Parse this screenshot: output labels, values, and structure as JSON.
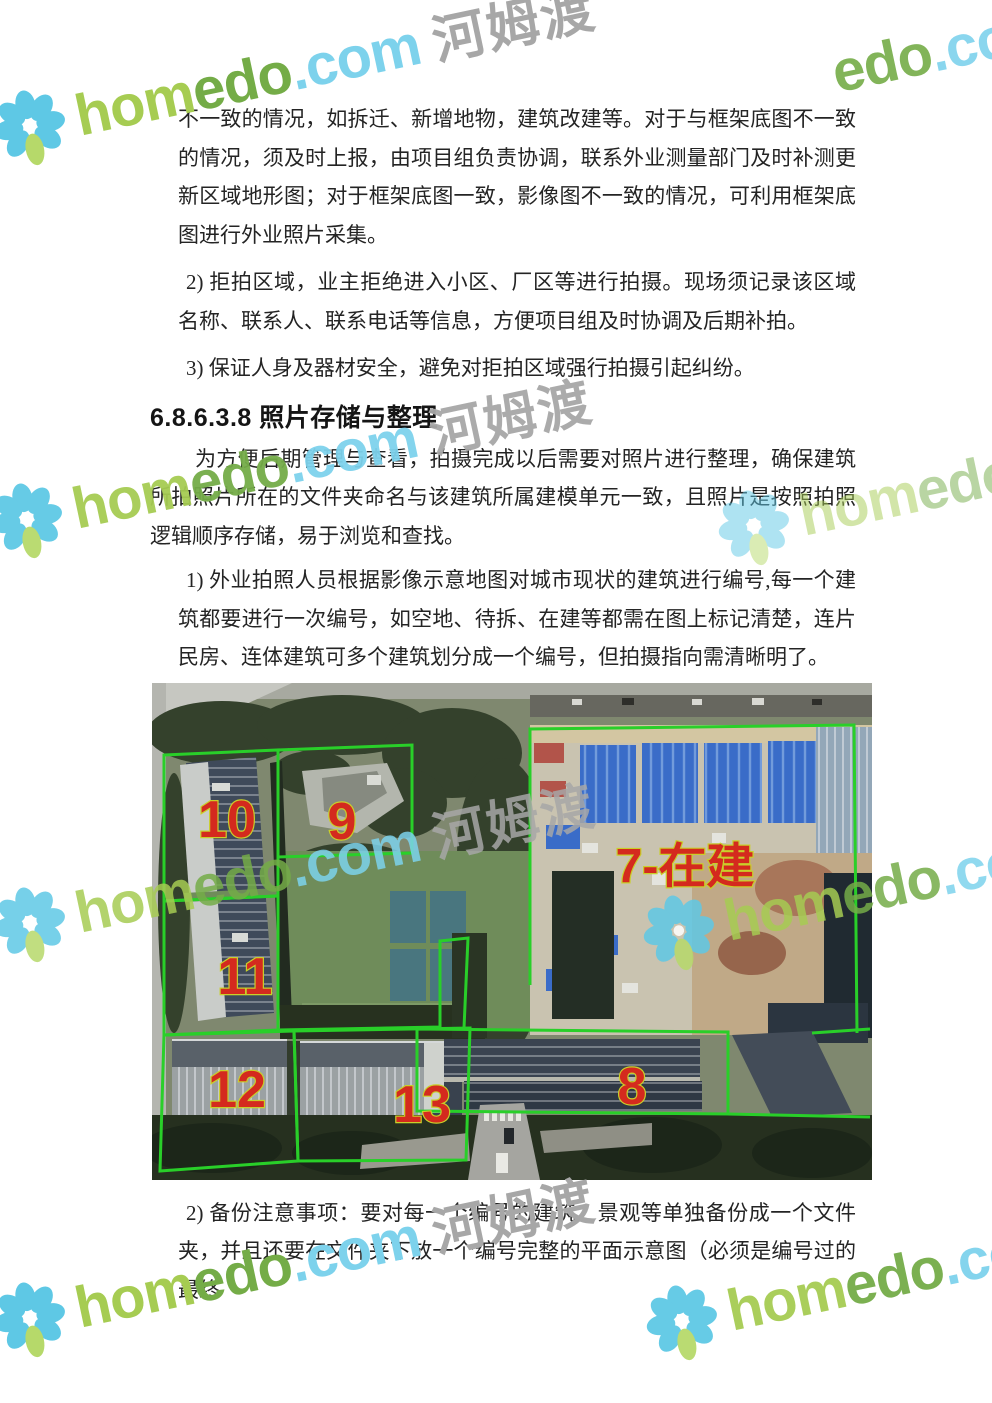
{
  "page": {
    "width": 992,
    "height": 1403,
    "background": "#ffffff"
  },
  "content": {
    "heading": "6.8.6.3.8 照片存储与整理",
    "paragraphs": [
      {
        "text": "不一致的情况，如拆迁、新增地物，建筑改建等。对于与框架底图不一致的情况，须及时上报，由项目组负责协调，联系外业测量部门及时补测更新区域地形图；对于框架底图一致，影像图不一致的情况，可利用框架底图进行外业照片采集。"
      },
      {
        "text": "2) 拒拍区域，业主拒绝进入小区、厂区等进行拍摄。现场须记录该区域名称、联系人、联系电话等信息，方便项目组及时协调及后期补拍。"
      },
      {
        "text": "3) 保证人身及器材安全，避免对拒拍区域强行拍摄引起纠纷。"
      },
      {
        "text": "为方便后期管理与查看，拍摄完成以后需要对照片进行整理，确保建筑所拍照片所在的文件夹命名与该建筑所属建模单元一致，且照片是按照拍照逻辑顺序存储，易于浏览和查找。"
      },
      {
        "text": "1) 外业拍照人员根据影像示意地图对城市现状的建筑进行编号,每一个建筑都要进行一次编号，如空地、待拆、在建等都需在图上标记清楚，连片民房、连体建筑可多个建筑划分成一个编号，但拍摄指向需清晰明了。"
      },
      {
        "text": "2) 备份注意事项：要对每一个编号的建筑、景观等单独备份成一个文件夹，并且还要在文件夹下放一个编号完整的平面示意图（必须是编号过的最终"
      }
    ]
  },
  "watermark": {
    "brand_part1": "hom",
    "brand_part2": "edo",
    "brand_suffix": ".com",
    "brand_cjk": "河姆渡",
    "colors": {
      "part1": "#a6cc52",
      "part2": "#74ac47",
      "suffix": "#7dd2ec",
      "cjk": "#a7a7a7",
      "petal": "#5ec8e5",
      "leaf": "#b6d96a"
    },
    "instances": [
      {
        "x": -7,
        "y": 93,
        "flower": true,
        "part1": true,
        "part2": true,
        "suffix": true,
        "cjk": true,
        "opacity": 1
      },
      {
        "x": 833,
        "y": 45,
        "flower": false,
        "part1": false,
        "part2": true,
        "suffix": true,
        "cjk": false,
        "opacity": 0.9
      },
      {
        "x": -10,
        "y": 486,
        "flower": true,
        "part1": true,
        "part2": true,
        "suffix": true,
        "cjk": true,
        "opacity": 0.95
      },
      {
        "x": 717,
        "y": 493,
        "flower": true,
        "part1": true,
        "part2": true,
        "suffix": true,
        "cjk": true,
        "opacity": 0.5
      },
      {
        "x": -7,
        "y": 890,
        "flower": true,
        "part1": true,
        "part2": true,
        "suffix": true,
        "cjk": true,
        "opacity": 0.85
      },
      {
        "x": 642,
        "y": 898,
        "flower": true,
        "part1": true,
        "part2": true,
        "suffix": true,
        "cjk": true,
        "opacity": 0.85
      },
      {
        "x": -7,
        "y": 1285,
        "flower": true,
        "part1": true,
        "part2": true,
        "suffix": true,
        "cjk": true,
        "opacity": 1
      },
      {
        "x": 645,
        "y": 1288,
        "flower": true,
        "part1": true,
        "part2": true,
        "suffix": true,
        "cjk": true,
        "opacity": 0.95
      }
    ]
  },
  "figure": {
    "outline_color": "#29cf29",
    "label_fill": "#d42a1e",
    "label_stroke": "#c9cf2a",
    "polygons": [
      {
        "points": "12,72 126,67 126,213 12,218",
        "closed": true
      },
      {
        "points": "12,218 126,213 126,347 12,352",
        "closed": true
      },
      {
        "points": "126,67 260,62 260,170 126,174",
        "closed": true
      },
      {
        "points": "126,347 288,344 288,258 316,255 312,345",
        "closed": false
      },
      {
        "points": "12,352 142,348 146,478 8,488",
        "closed": true
      },
      {
        "points": "142,348 318,345 314,477 146,478",
        "closed": true
      },
      {
        "points": "378,302 378,46 702,42 705,350",
        "closed": false
      },
      {
        "points": "265,346 576,349 576,431 265,428",
        "closed": true
      },
      {
        "points": "576,431 718,434",
        "closed": false
      },
      {
        "points": "660,350 718,346",
        "closed": false
      }
    ],
    "labels": [
      {
        "text": "10",
        "x": 75,
        "y": 137,
        "size": 52
      },
      {
        "text": "9",
        "x": 190,
        "y": 139,
        "size": 52
      },
      {
        "text": "7-在建",
        "x": 533,
        "y": 184,
        "size": 48
      },
      {
        "text": "11",
        "x": 93,
        "y": 294,
        "size": 52
      },
      {
        "text": "12",
        "x": 85,
        "y": 407,
        "size": 52
      },
      {
        "text": "13",
        "x": 270,
        "y": 422,
        "size": 52
      },
      {
        "text": "8",
        "x": 480,
        "y": 404,
        "size": 52
      }
    ]
  }
}
